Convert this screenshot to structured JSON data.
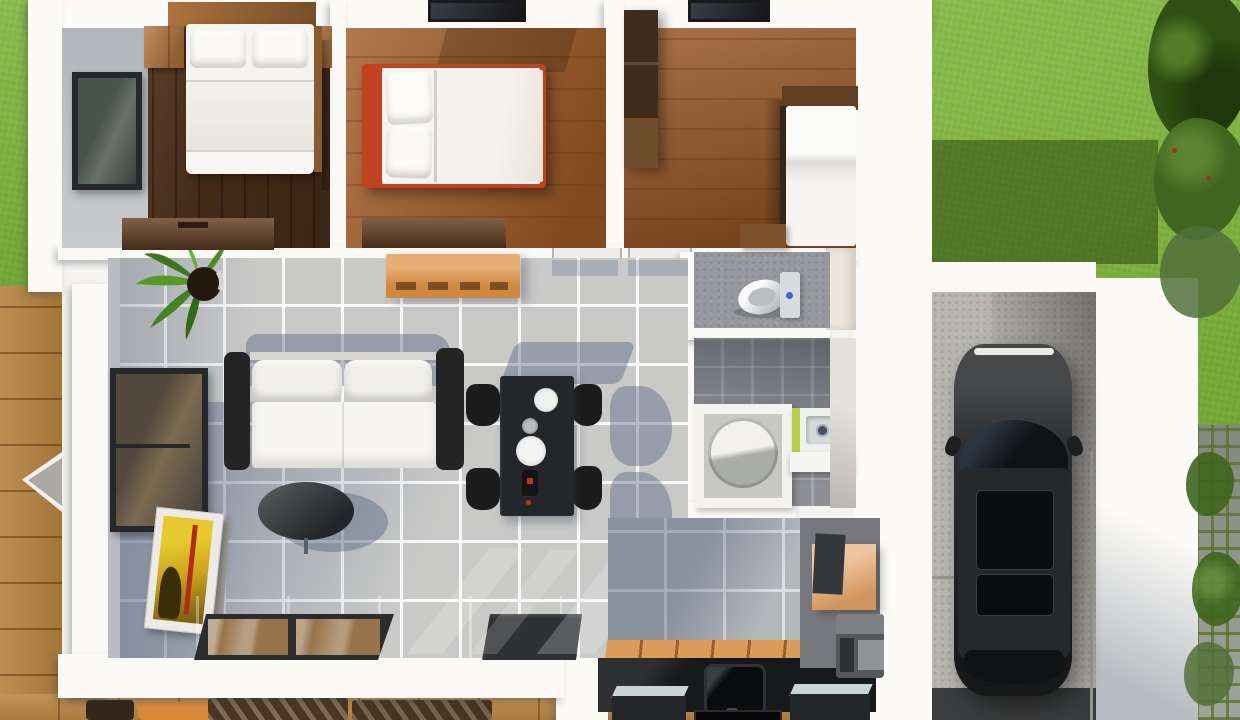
{
  "scene": {
    "kind": "3d-floor-plan-render-top-view",
    "description": "Photorealistic top-down 3D render of a small single-storey house with three bedrooms, open living/dining/kitchen area, bathroom, WC, laundry nook and attached single garage with a parked dark car; lawn, timber decks and a stone garden path surround the building.",
    "visible_text": "none"
  },
  "palette": {
    "lawn": "#7cb437",
    "lawn_shadow": "rgba(25,50,5,0.45)",
    "foliage_dark": "#2f4f13",
    "foliage_mid": "#3f651e",
    "foliage_light": "#52703a",
    "deck_wood": "#b5823f",
    "deck_wood_light": "#c08c4a",
    "stone_path": "#9aa095",
    "wall_white": "#fbfaf7",
    "wall_face_gray": "#b9bcc0",
    "wall_beige": "#ece6dc",
    "bedroom1_floor": "#5d3a21",
    "bedroom2_floor": "#a2622c",
    "bedroom3_floor": "#9e5f2e",
    "living_tile": "#c9c9c7",
    "bath_tile": "#8d8f94",
    "wc_tile": "#97989d",
    "laundry_tile": "#76787d",
    "kitchen_counter": "#17191b",
    "kitchen_mat_wood": "#da9c57",
    "cabinet_orange": "#df9344",
    "laundry_cabinet_orange": "#e8a569",
    "bed_frame_red": "#c14120",
    "bedding_white": "#f5f4f0",
    "nightstand_wood": "#b5793f",
    "dresser_wood": "#6a4527",
    "wardrobe_wood": "#3f2c1c",
    "sofa_black": "#242424",
    "cushion_white": "#f0efeb",
    "coffee_table_gray": "#383c40",
    "dining_table_black": "#24272a",
    "chair_black": "#1c1c1c",
    "sliding_door_frame": "#2a2c2e",
    "door_glass_wood_reflection": "#97744a",
    "doormat_dark": "#2f3234",
    "toilet_white": "#eff1f1",
    "shower_round_gray": "#a9aca8",
    "sink_green": "#b8cf48",
    "washer_gray": "#54585b",
    "concrete": "#b7b5b1",
    "garage_entry_dark": "#3c3d3e",
    "car_body": "#232527",
    "car_glass": "#101214",
    "shadow_blue": "rgba(75,92,122,0.40)"
  },
  "rooms": [
    {
      "id": "bedroom-1",
      "position": "top-left",
      "floor": "dark-walnut-planks",
      "furniture": [
        "double-bed-white-bedding",
        "pillow x2",
        "wood-headboard-shelf",
        "nightstand-left",
        "nightstand-right",
        "dresser",
        "window-west"
      ]
    },
    {
      "id": "bedroom-2",
      "position": "top-middle",
      "floor": "chestnut-planks",
      "furniture": [
        "double-bed-red-frame-white-bedding",
        "pillow x2",
        "dresser",
        "ceiling-skylight"
      ]
    },
    {
      "id": "bedroom-3",
      "position": "top-right",
      "floor": "chestnut-planks",
      "furniture": [
        "wardrobe",
        "single-bed-white",
        "wood-headboard",
        "stool",
        "ceiling-skylight"
      ]
    },
    {
      "id": "wc",
      "position": "center-right",
      "floor": "gray-tile",
      "furniture": [
        "toilet-with-cistern"
      ]
    },
    {
      "id": "bathroom",
      "position": "right",
      "floor": "gray-tile",
      "furniture": [
        "round-shower-in-enclosure",
        "sink-unit-green-side",
        "white-counter"
      ]
    },
    {
      "id": "laundry-nook",
      "position": "lower-right",
      "furniture": [
        "orange-cabinet",
        "washing-machine"
      ]
    },
    {
      "id": "living-room",
      "position": "center-left",
      "floor": "light-gray-tile",
      "furniture": [
        "black-sofa-white-cushions",
        "oval-coffee-table",
        "potted-plant",
        "orange-console",
        "leaning-artwork-frames",
        "window-west",
        "sliding-glass-door-south",
        "dark-doormat"
      ]
    },
    {
      "id": "dining-area",
      "position": "center",
      "furniture": [
        "black-dining-table",
        "dining-chair x4",
        "plate x2",
        "bowl",
        "bottle"
      ]
    },
    {
      "id": "kitchen",
      "position": "bottom-center",
      "furniture": [
        "black-counter-with-sink",
        "appliance-glass-top x2",
        "cooktop",
        "wood-mat-strip",
        "orange-cabinets"
      ]
    },
    {
      "id": "garage",
      "position": "right",
      "floor": "concrete",
      "furniture": [
        "car-dark-sedan",
        "guard-rail"
      ]
    }
  ],
  "exterior": {
    "areas": [
      "lawn-top-left",
      "lawn-top-right-with-tree-shadow",
      "shrubs-east",
      "stone-path-east-with-moss",
      "timber-deck-west-with-shade-sail",
      "timber-deck-south-with-outdoor-furniture",
      "garage-driveway-edge"
    ],
    "outdoor_furniture": [
      "striped-lounger x2",
      "orange-deck-chair",
      "small-outdoor-table"
    ]
  }
}
